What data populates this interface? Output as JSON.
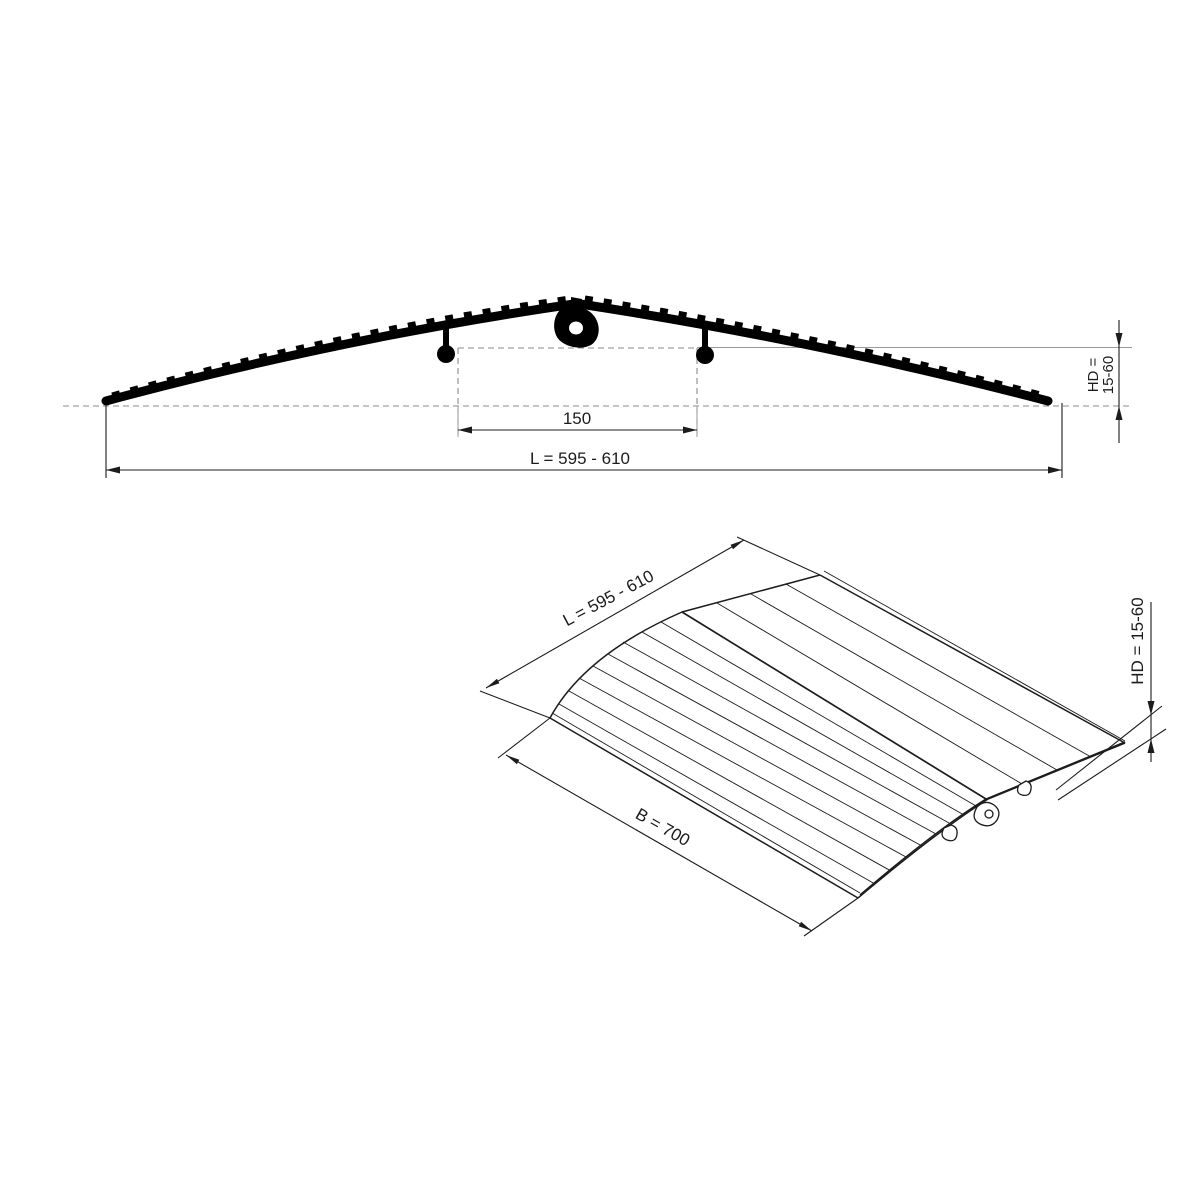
{
  "drawing": {
    "type": "technical-drawing",
    "subject": "threshold-ramp",
    "side_view": {
      "dim_inner": "150",
      "dim_length": "L = 595 - 610",
      "dim_height_line1": "HD =",
      "dim_height_line2": "15-60"
    },
    "iso_view": {
      "dim_length": "L = 595 - 610",
      "dim_width": "B = 700",
      "dim_height": "HD = 15-60"
    },
    "colors": {
      "background": "#ffffff",
      "line": "#1c1c1c",
      "profile_fill": "#000000",
      "dashed_reference": "#8a8a8a"
    }
  }
}
